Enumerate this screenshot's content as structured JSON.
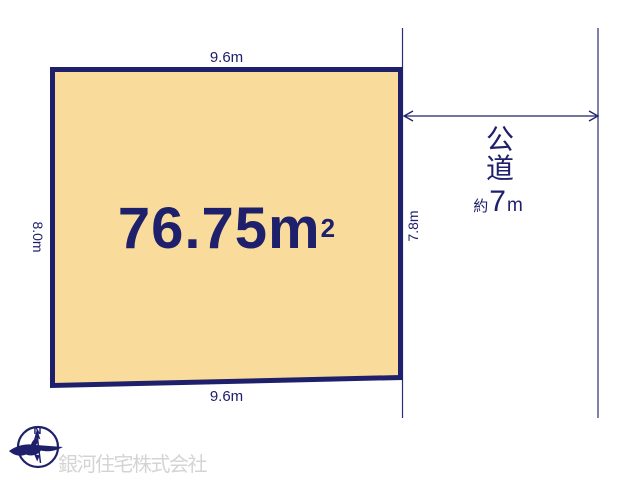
{
  "colors": {
    "line_navy": "#1E206B",
    "parcel_fill": "#F9DC9C",
    "company_gray": "#D4D4D4",
    "background": "#FFFFFF"
  },
  "parcel": {
    "area_value": "76.75",
    "area_unit": "m",
    "area_exponent": "2",
    "dimensions": {
      "top": "9.6m",
      "bottom": "9.6m",
      "left": "8.0m",
      "right": "7.8m"
    }
  },
  "road": {
    "name_vertical": [
      "公",
      "道"
    ],
    "width_prefix": "約",
    "width_value": "7",
    "width_unit": "m"
  },
  "compass": {
    "north_label": "N"
  },
  "footer": {
    "company_name": "銀河住宅株式会社"
  }
}
